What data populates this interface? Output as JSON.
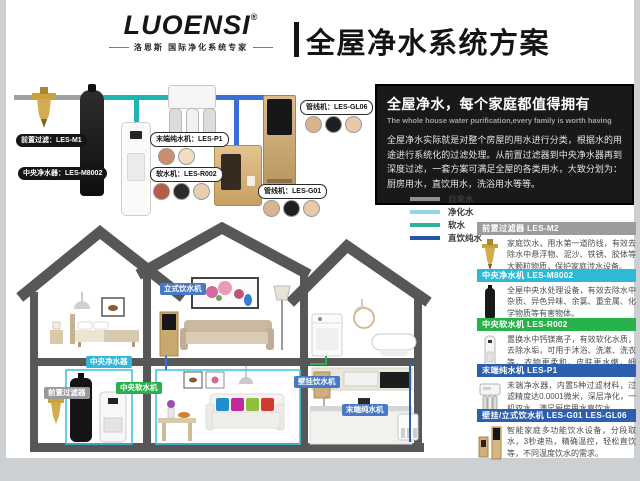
{
  "header": {
    "logo": "LUOENSI",
    "reg": "®",
    "tagline": "洛恩斯 国际净化系统专家",
    "title": "全屋净水系统方案"
  },
  "hero": {
    "title": "全屋净水，每个家庭都值得拥有",
    "subtitle": "The whole house water purification,every family is worth having",
    "body": "全屋净水实际就是对整个房屋的用水进行分类，根据水的用途进行系统化的过滤处理。从前置过滤器到中央净水器再到深度过滤，一套方案可满足全屋的各类用水，大致分划为：厨房用水，直饮用水，洗浴用水等等。"
  },
  "legend": {
    "items": [
      {
        "label": "自来水",
        "color": "#8e9296"
      },
      {
        "label": "净化水",
        "color": "#8fd7ea"
      },
      {
        "label": "软水",
        "color": "#2eb398"
      },
      {
        "label": "直饮纯水",
        "color": "#2356a7"
      }
    ]
  },
  "diagram": {
    "bubbles": [
      {
        "id": "prefilter",
        "text": "前置过滤：LES-M1"
      },
      {
        "id": "central-purifier",
        "text": "中央净水器：LES-M8002"
      },
      {
        "id": "terminal-ro",
        "text": "末端纯水机：LES-P1"
      },
      {
        "id": "softener",
        "text": "软水机：LES-R002"
      },
      {
        "id": "pipeline-wall",
        "text": "管线机：LES-GL06"
      },
      {
        "id": "pipeline-stand",
        "text": "管线机：LES-G01"
      }
    ]
  },
  "house": {
    "badges": [
      {
        "id": "standing-dispenser",
        "text": "立式饮水机",
        "color": "#4a79c4"
      },
      {
        "id": "central-purifier",
        "text": "中央净水器",
        "color": "#35b6d9"
      },
      {
        "id": "prefilter",
        "text": "前置过滤器",
        "color": "#98999b"
      },
      {
        "id": "central-softener",
        "text": "中央软水机",
        "color": "#27b24b"
      },
      {
        "id": "wall-dispenser",
        "text": "壁挂饮水机",
        "color": "#4a79c4"
      },
      {
        "id": "terminal-ro",
        "text": "末端纯水机",
        "color": "#4a79c4"
      }
    ]
  },
  "products": [
    {
      "name": "前置过滤器 LES-M2",
      "header_color": "#9c9c9c",
      "desc": "家庭饮水，用水第一道防线，有效去除水中悬浮物、泥沙、铁锈、胶体等大颗粒物质，保护家庭涉水设备。"
    },
    {
      "name": "中央净水机 LES-M8002",
      "header_color": "#2fb9d9",
      "desc": "全屋中央水处理设备，有效去除水中杂质、异色异味、余氯、重金属、化学物质等有害物体。"
    },
    {
      "name": "中央软水机 LES-R002",
      "header_color": "#27b24b",
      "desc": "置换水中钙镁离子，有效软化水质，去除水垢，可用于沐浴、洗漱、洗衣等，衣物更柔和，皮肤更水嫩，细腻。"
    },
    {
      "name": "末端纯水机 LES-P1",
      "header_color": "#2c5fad",
      "desc": "末端净水器，内置5种过滤材料，过滤精度达0.0001微米，深层净化，一机双水，满足厨房用水直饮水。"
    },
    {
      "name": "壁挂/立式饮水机 LES-G01  LES-GL06",
      "header_color": "#2c5fad",
      "desc": "智能家庭多功能饮水设备，分段取水，3秒速热，精确温控，轻松直饮等，不同温度饮水的需求。"
    }
  ]
}
